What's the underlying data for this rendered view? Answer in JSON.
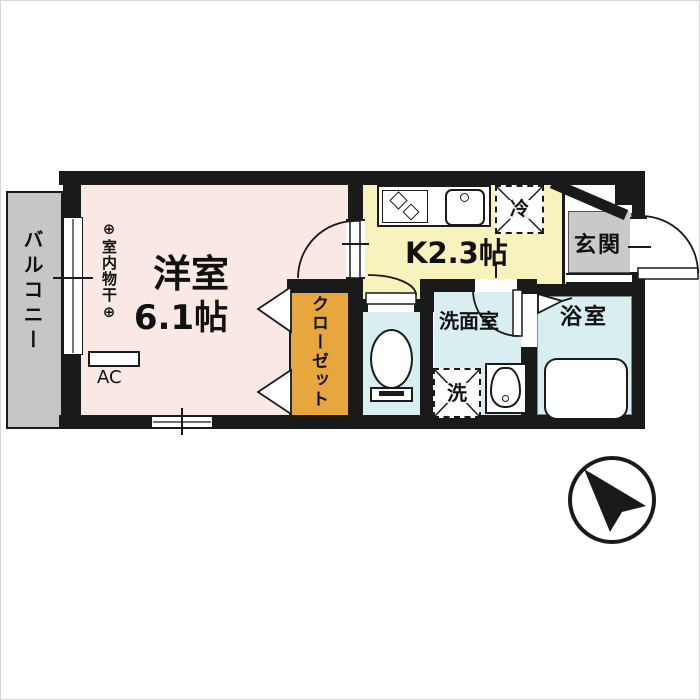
{
  "floorplan": {
    "balcony": {
      "label": "バルコニー"
    },
    "main_room": {
      "name": "洋室",
      "size": "6.1帖",
      "drying_note": "⊕室内物干⊕",
      "ac_label": "AC"
    },
    "closet": {
      "label": "クローゼット"
    },
    "kitchen": {
      "label": "K2.3帖",
      "fridge_label": "冷"
    },
    "entrance": {
      "label": "玄関"
    },
    "washroom": {
      "label": "洗面室",
      "laundry_label": "洗"
    },
    "bathroom": {
      "label": "浴室"
    },
    "compass": {
      "icon": "north-arrow-icon",
      "points": "north-west"
    }
  },
  "colors": {
    "wall": "#1a1a1a",
    "main_room_fill": "#fae8e5",
    "kitchen_fill": "#f8f3bd",
    "wet_area_fill": "#d9eef1",
    "closet_fill": "#e8a63e",
    "balcony_fill": "#c6c6c6",
    "entrance_fill": "#c9c9c9"
  }
}
